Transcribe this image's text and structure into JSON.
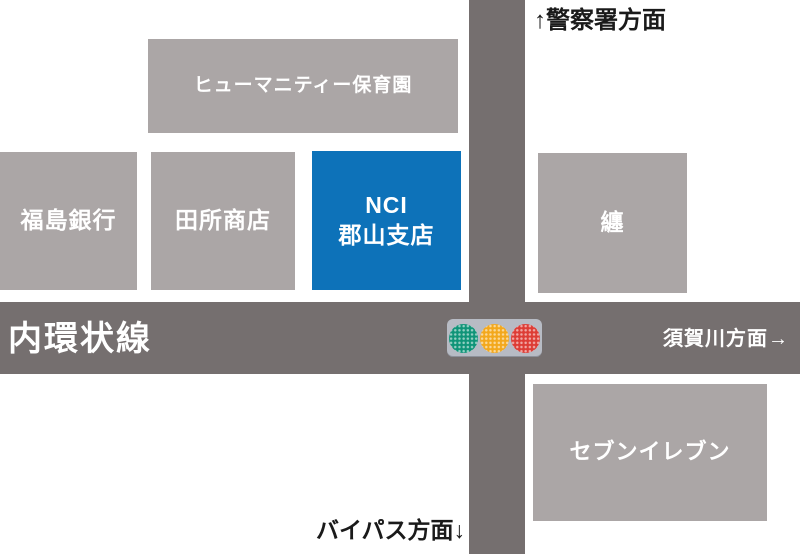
{
  "roads": {
    "horizontal_name": "内環状線"
  },
  "directions": {
    "north": "↑警察署方面",
    "east": "須賀川方面→",
    "south": "バイパス方面↓"
  },
  "buildings": {
    "nursery": {
      "label": "ヒューマニティー保育園"
    },
    "bank": {
      "label": "福島銀行"
    },
    "shop": {
      "label": "田所商店"
    },
    "nci": {
      "label_line1": "NCI",
      "label_line2": "郡山支店"
    },
    "matoi": {
      "label": "纏"
    },
    "seven_eleven": {
      "label": "セブンイレブン"
    }
  },
  "traffic_light": {
    "lights": [
      "green",
      "yellow",
      "red"
    ]
  },
  "colors": {
    "building_gray": "#aba6a6",
    "road_gray": "#756f6f",
    "highlight_blue": "#0d72b9",
    "signal_housing": "#b7bbc4",
    "signal_green": "#0f9478",
    "signal_yellow": "#f3a81c",
    "signal_red": "#dd3c35",
    "label_black": "#1a1a1a"
  }
}
